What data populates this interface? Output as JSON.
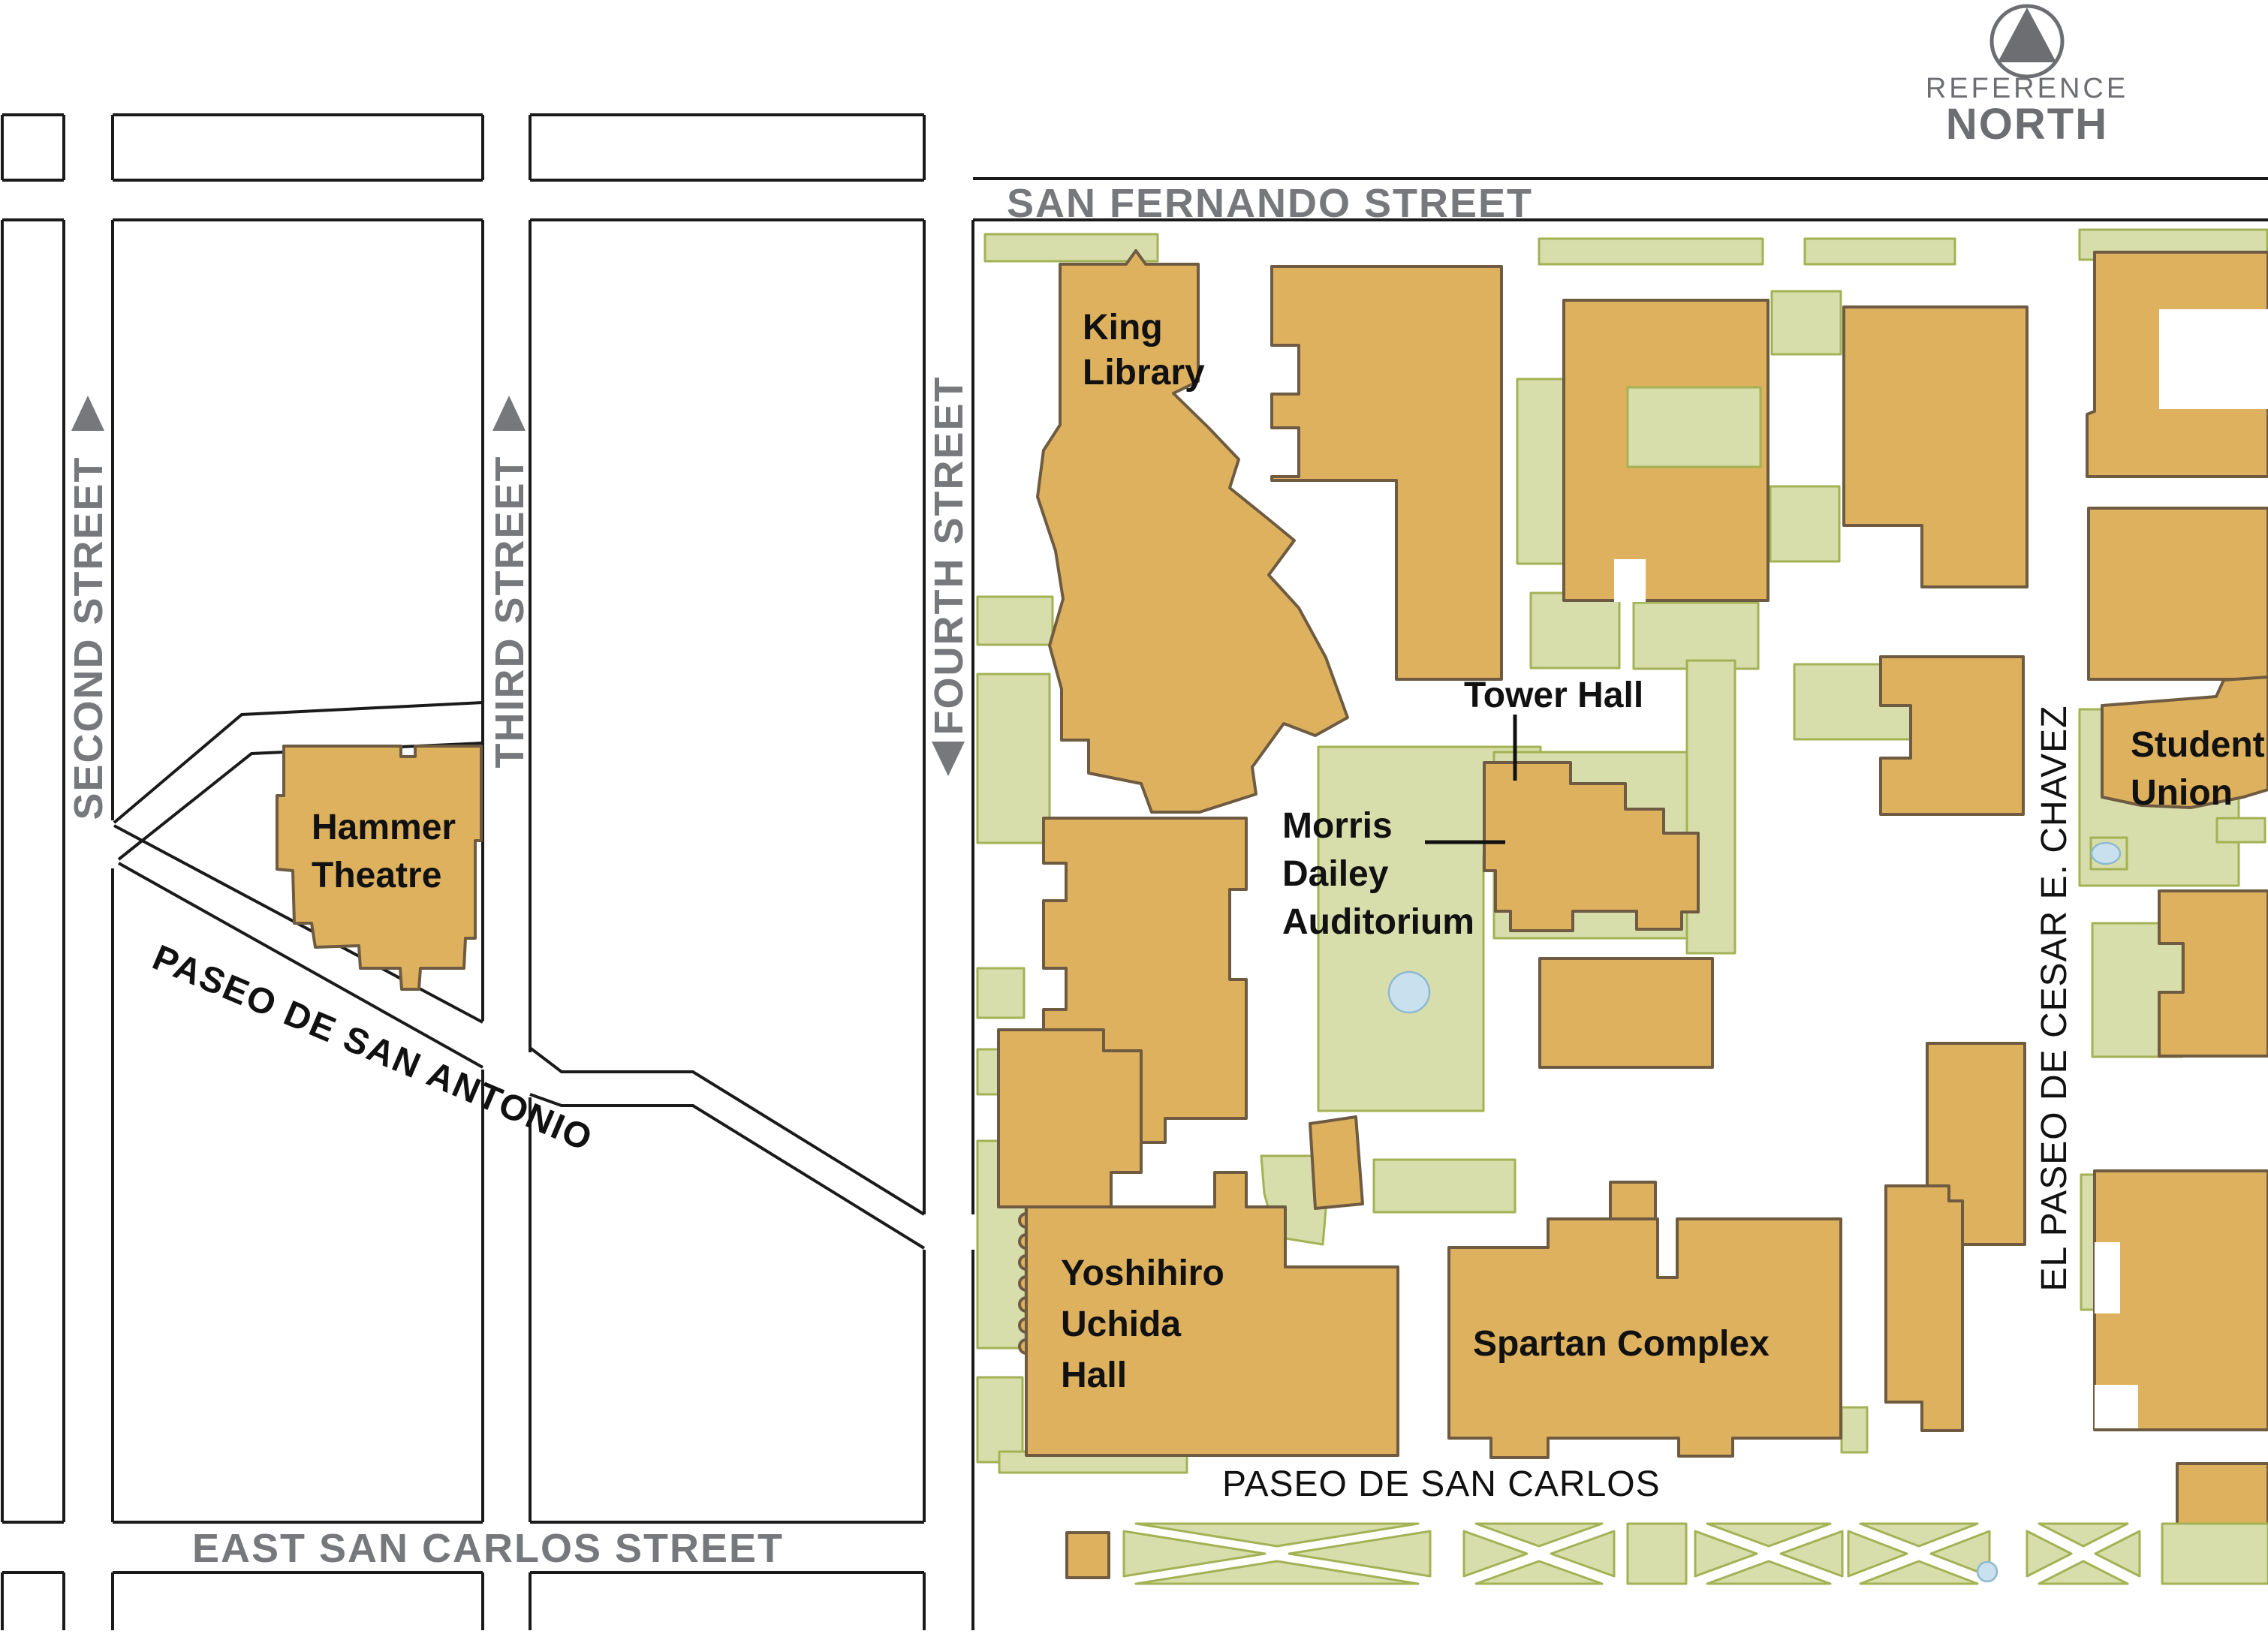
{
  "compass": {
    "icon": "north-triangle-in-circle",
    "line1": "REFERENCE",
    "line2": "NORTH"
  },
  "streets": {
    "san_fernando": "SAN FERNANDO STREET",
    "second": "SECOND STREET",
    "third": "THIRD STREET",
    "fourth": "FOURTH STREET",
    "east_san_carlos": "EAST SAN CARLOS STREET",
    "paseo_de_san_antonio": "PASEO DE SAN ANTONIO",
    "paseo_de_san_carlos": "PASEO DE SAN CARLOS",
    "el_paseo_de_cesar_chavez": "EL PASEO DE CESAR E. CHAVEZ",
    "second_arrow_icon": "up-arrow",
    "third_arrow_icon": "up-arrow",
    "fourth_arrow_icon": "down-arrow"
  },
  "buildings": {
    "king_library": {
      "line1": "King",
      "line2": "Library"
    },
    "hammer_theatre": {
      "line1": "Hammer",
      "line2": "Theatre"
    },
    "tower_hall": {
      "label": "Tower Hall"
    },
    "morris_dailey": {
      "line1": "Morris",
      "line2": "Dailey",
      "line3": "Auditorium"
    },
    "student_union": {
      "line1": "Student",
      "line2": "Union"
    },
    "yoshihiro_uchida": {
      "line1": "Yoshihiro",
      "line2": "Uchida",
      "line3": "Hall"
    },
    "spartan_complex": {
      "label": "Spartan Complex"
    }
  },
  "map_features": {
    "ponds": [
      "central-plaza-pond",
      "student-union-pond",
      "paseo-san-carlos-pond"
    ],
    "landscaping": "green-patches",
    "blocks": "white-city-blocks"
  },
  "colors": {
    "building_fill": "#DDB15E",
    "building_stroke": "#6E5B41",
    "green_fill": "#D7DEAC",
    "green_stroke": "#A3B254",
    "water_fill": "#C9E0EE",
    "water_stroke": "#8FB9CF",
    "street_line": "#1A1A1A",
    "street_label_gray": "#77787B",
    "compass_gray": "#6D6E71",
    "label_black": "#111111",
    "background": "#FFFFFF"
  }
}
